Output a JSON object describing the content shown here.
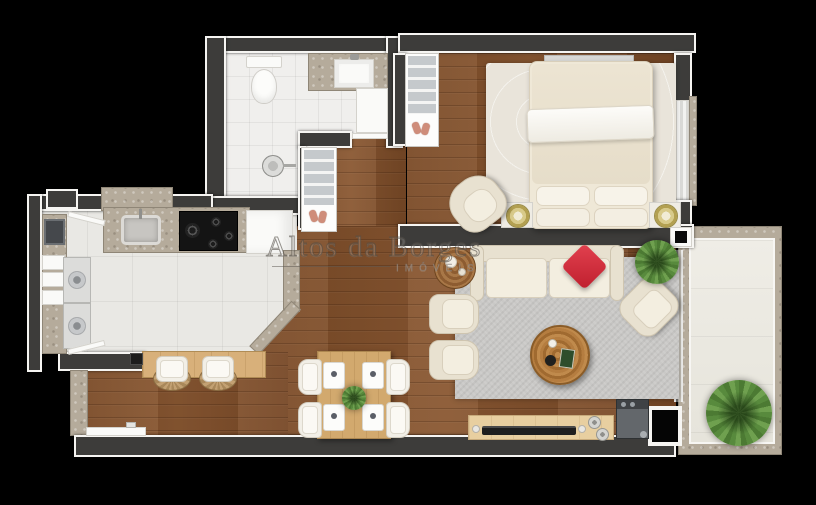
{
  "watermark": {
    "title": "Altos da Borges",
    "subtitle": "IMÓVEIS"
  },
  "palette": {
    "background": "#000000",
    "wall": "#3d3c3a",
    "wall_outline": "#f6f5f2",
    "wood_floor": "#7d4e2a",
    "bath_tile": "#f0efed",
    "kitchen_tile": "#e9e8e4",
    "marble_counter": "#b5ab9b",
    "living_rug": "#c9c8c6",
    "bedroom_rug": "#e9e4da",
    "upholstery_cream": "#e8e1d0",
    "accent_pillow_red": "#d42b3a",
    "plant_green": "#5c8f3f",
    "bar_counter_wood": "#d8b07a",
    "dining_table_wood": "#d2a96e",
    "tv_console_wood": "#e8cfa0",
    "stove_black": "#151515",
    "lamp_gold": "#cfc076"
  }
}
